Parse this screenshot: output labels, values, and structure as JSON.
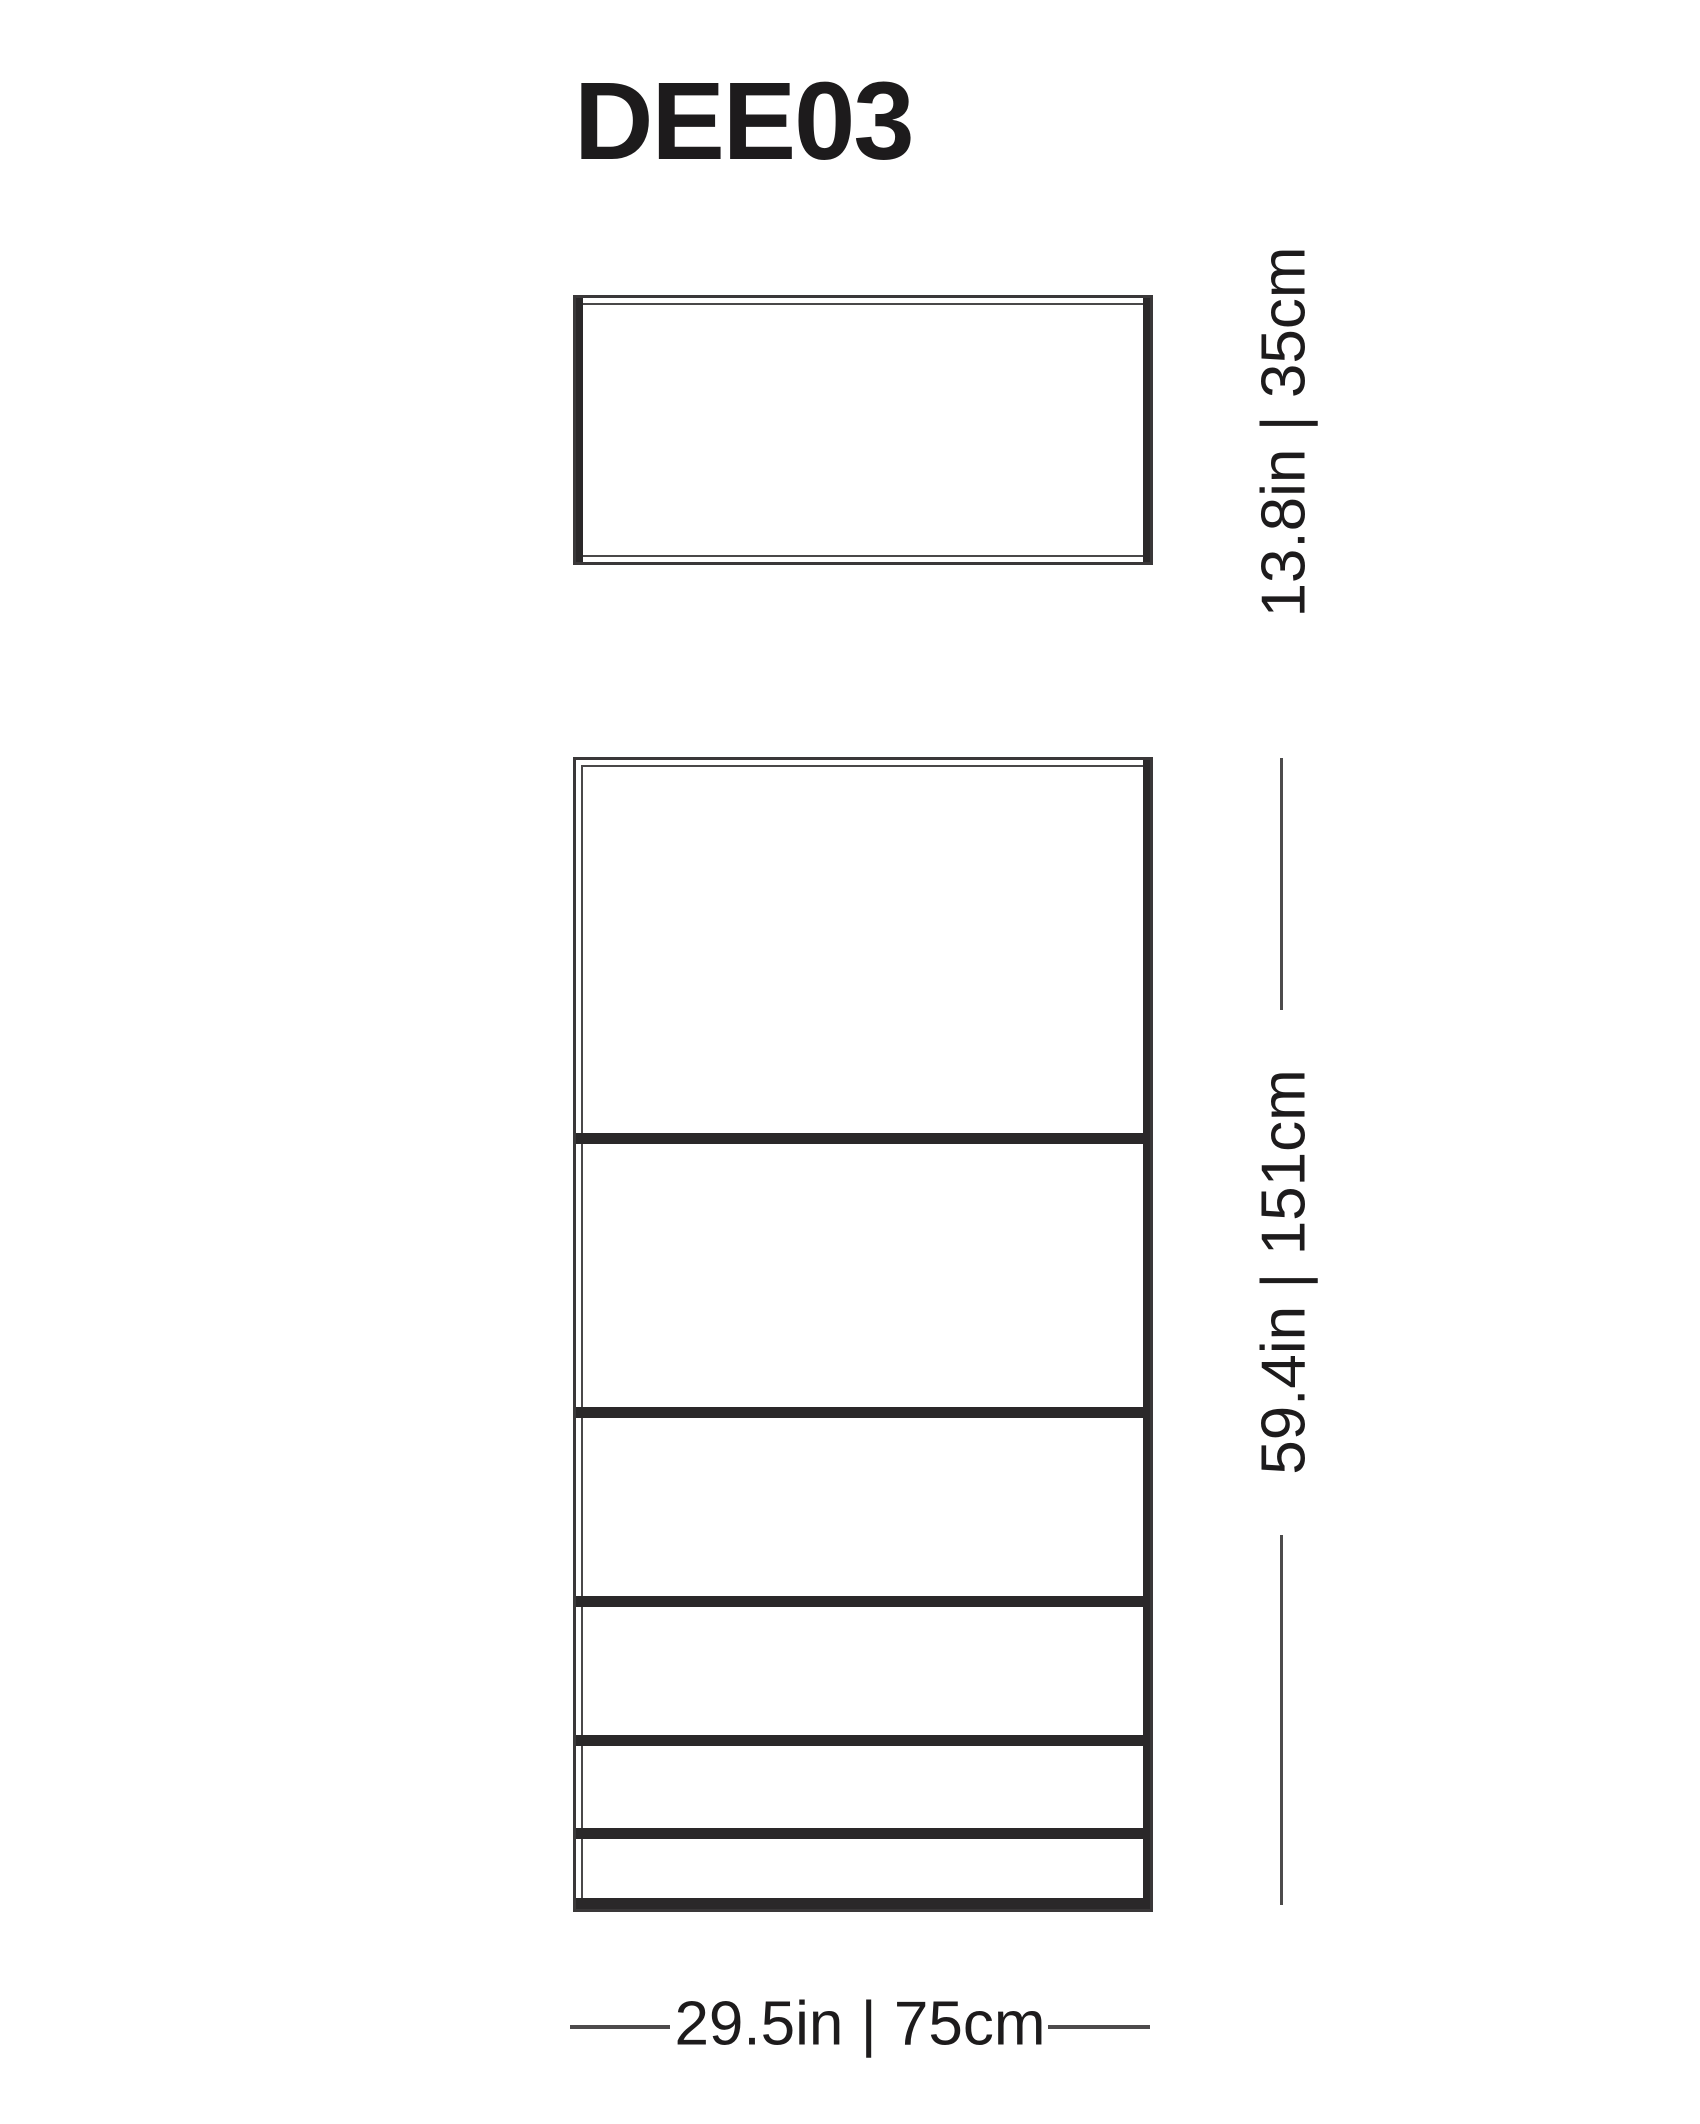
{
  "title": "DEE03",
  "dimension_labels": {
    "depth": "13.8in | 35cm",
    "height": "59.4in | 151cm",
    "width": "29.5in | 75cm"
  },
  "dimensions": {
    "depth": {
      "inches": 13.8,
      "cm": 35
    },
    "height": {
      "inches": 59.4,
      "cm": 151
    },
    "width": {
      "inches": 29.5,
      "cm": 75
    }
  },
  "front_view": {
    "shelf_divider_offsets_px": [
      373,
      647,
      836,
      975,
      1068
    ],
    "bottom_shelf_offset_px": 1138,
    "divider_thickness_px": 11
  },
  "colors": {
    "line": "#3a3839",
    "panel_bar": "#2a2829",
    "inner_line": "#4a4849",
    "dim_line": "#4d4b4c",
    "text": "#1d1b1c",
    "background": "#ffffff"
  }
}
